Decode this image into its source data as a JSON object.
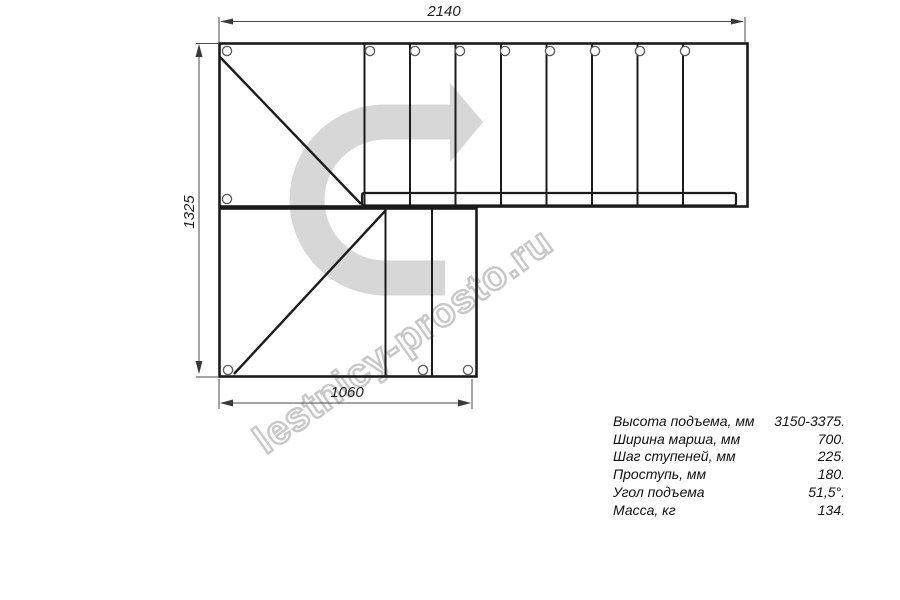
{
  "drawing": {
    "title": "staircase-top-view-plan",
    "dimensions": {
      "top": "2140",
      "left": "1325",
      "bottom": "1060"
    },
    "watermark": "lestnicy-prosto.ru",
    "icons": {
      "direction_arrow": "curved-right-turn-arrow"
    },
    "colors": {
      "background": "#ffffff",
      "line_ink": "#1b1b1b",
      "dimension_line": "#4a4a4a",
      "arrow_gray": "#d7d7d7",
      "watermark_gray": "#c8c8c8"
    }
  },
  "specs": {
    "rows": [
      {
        "label": "Высота подъема, мм",
        "value": "3150-3375."
      },
      {
        "label": "Ширина марша, мм",
        "value": "700."
      },
      {
        "label": "Шаг ступеней, мм",
        "value": "225."
      },
      {
        "label": "Проступь, мм",
        "value": "180."
      },
      {
        "label": "Угол подъема",
        "value": "51,5°."
      },
      {
        "label": "Масса, кг",
        "value": "134."
      }
    ]
  }
}
